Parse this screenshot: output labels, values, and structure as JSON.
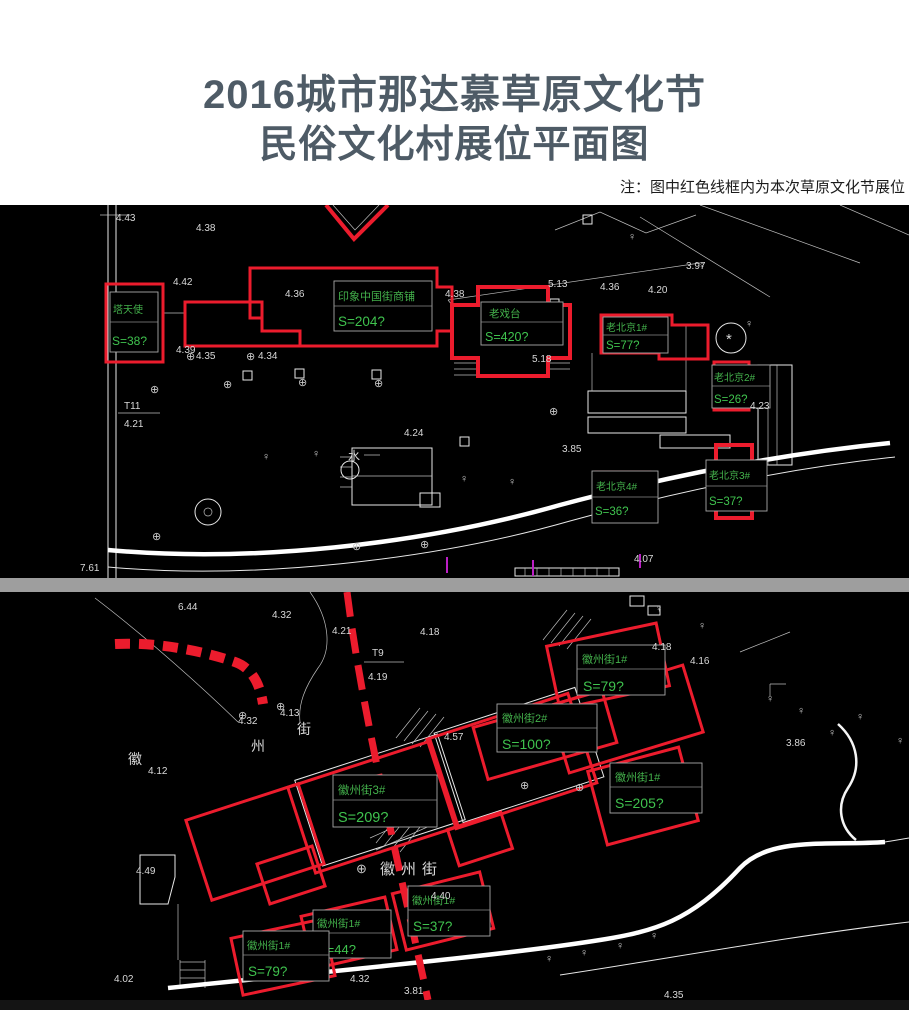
{
  "header": {
    "title_line1": "2016城市那达慕草原文化节",
    "title_line2": "民俗文化村展位平面图",
    "note": "注：图中红色线框内为本次草原文化节展位"
  },
  "colors": {
    "booth_outline": "#ec1c2d",
    "label_green": "#43b14b",
    "cad_line": "#ffffff",
    "plan_background": "#000000",
    "divider_gray": "#9e9e9e",
    "title_color": "#4e5b66"
  },
  "icons": {
    "tree_symbol": "♀",
    "round_mark": "⊕",
    "star_mark": "*"
  },
  "top_plan": {
    "booths": [
      {
        "name": "塔天使",
        "area": "S=38?"
      },
      {
        "name": "印象中国街商铺",
        "area": "S=204?"
      },
      {
        "name": "老戏台",
        "area": "S=420?"
      },
      {
        "name": "老北京1#",
        "area": "S=77?"
      },
      {
        "name": "老北京2#",
        "area": "S=26?"
      },
      {
        "name": "老北京3#",
        "area": "S=37?"
      },
      {
        "name": "老北京4#",
        "area": "S=36?"
      }
    ],
    "marks": {
      "t11": "T11",
      "t11_value": "4.21",
      "water": "水"
    },
    "elevations": [
      "4.43",
      "4.38",
      "4.42",
      "4.36",
      "4.39",
      "4.35",
      "4.34",
      "5.13",
      "4.36",
      "4.20",
      "3.97",
      "4.38",
      "5.18",
      "3.85",
      "4.24",
      "4.23",
      "4.07",
      "7.61"
    ]
  },
  "bottom_plan": {
    "booths": [
      {
        "name": "徽州街1#",
        "area": "S=79?"
      },
      {
        "name": "徽州街2#",
        "area": "S=100?"
      },
      {
        "name": "徽州街3#",
        "area": "S=209?"
      },
      {
        "name": "徽州街1#",
        "area": "S=205?"
      },
      {
        "name": "徽州街1#",
        "area": "S=37?"
      },
      {
        "name": "徽州街1#",
        "area": "S=44?"
      },
      {
        "name": "徽州街1#",
        "area": "S=79?"
      }
    ],
    "street_name": "徽州街",
    "street_chars": [
      "街",
      "州",
      "徽"
    ],
    "marks": {
      "t9": "T9",
      "t9_value": "4.19"
    },
    "elevations": [
      "6.44",
      "4.21",
      "4.18",
      "4.18",
      "4.16",
      "4.13",
      "4.32",
      "4.32",
      "4.12",
      "4.57",
      "3.86",
      "4.40",
      "4.49",
      "4.32",
      "4.02",
      "3.81",
      "4.35"
    ]
  }
}
